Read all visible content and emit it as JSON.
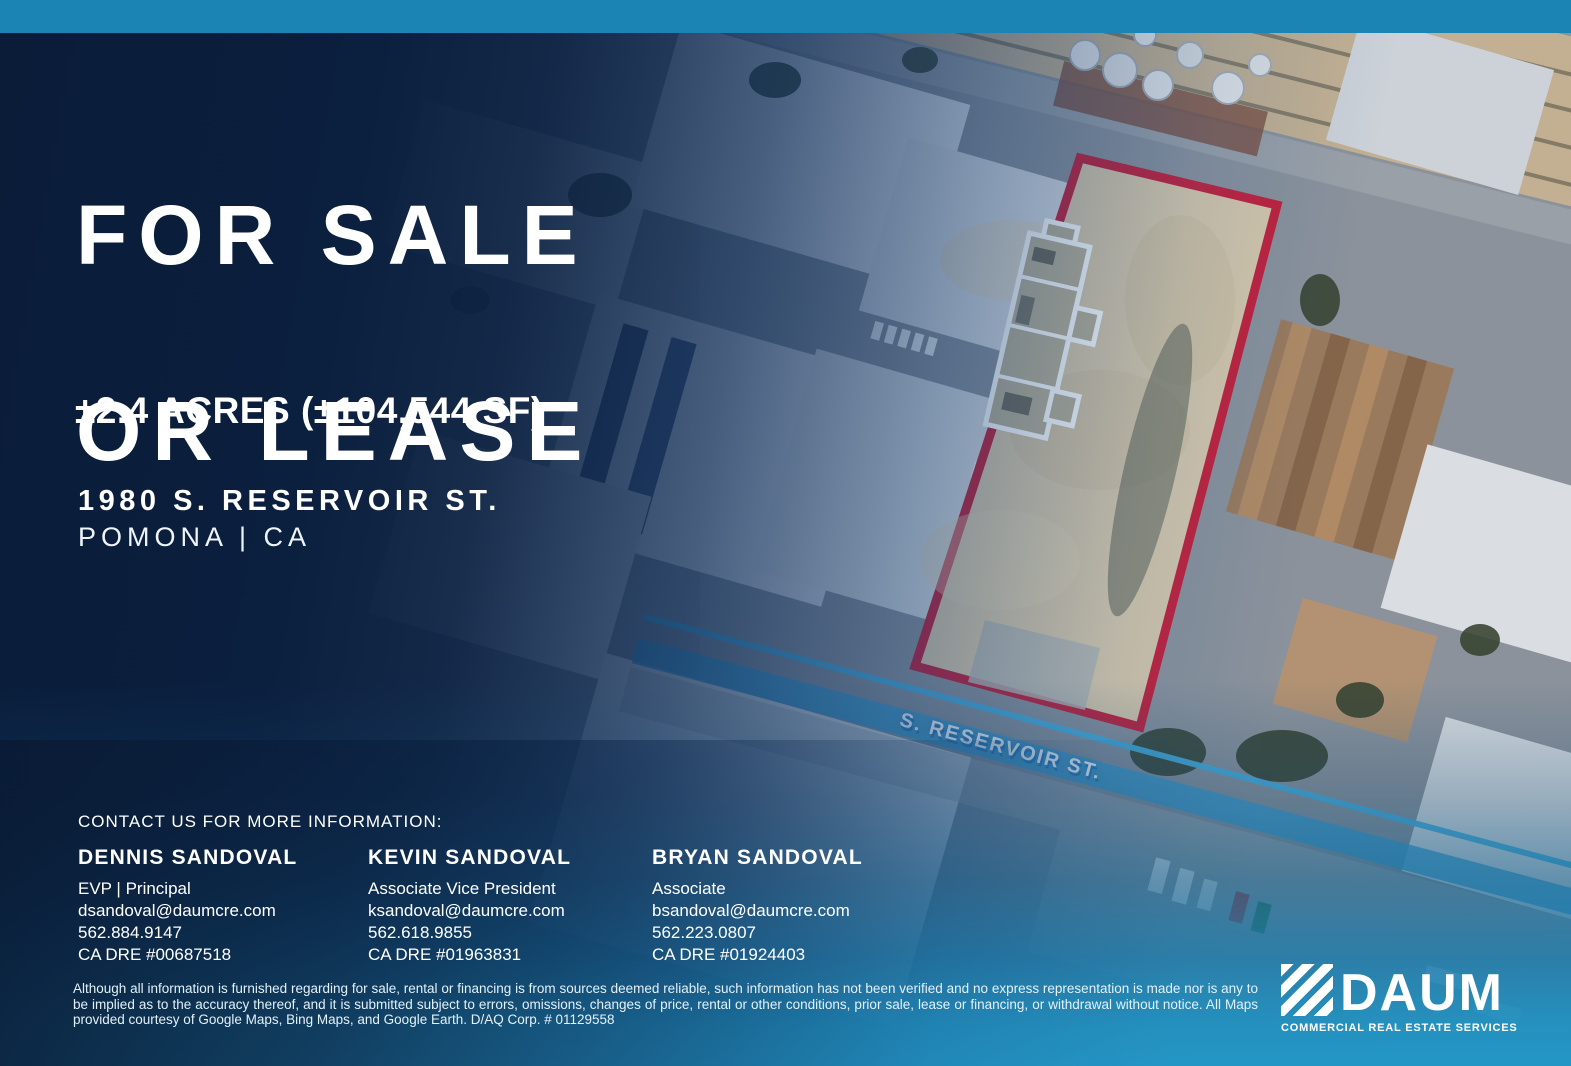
{
  "listing": {
    "title_line1": "FOR SALE",
    "title_line2": "OR LEASE",
    "size": "±2.4 ACRES (±104,544 SF)",
    "address_line1": "1980 S. RESERVOIR ST.",
    "address_line2": "POMONA | CA"
  },
  "map": {
    "street_label": "S. RESERVOIR ST."
  },
  "contact": {
    "heading": "CONTACT US FOR MORE INFORMATION:",
    "agents": [
      {
        "name": "DENNIS SANDOVAL",
        "title": "EVP | Principal",
        "email": "dsandoval@daumcre.com",
        "phone": "562.884.9147",
        "license": "CA DRE #00687518"
      },
      {
        "name": "KEVIN SANDOVAL",
        "title": "Associate Vice President",
        "email": "ksandoval@daumcre.com",
        "phone": "562.618.9855",
        "license": "CA DRE #01963831"
      },
      {
        "name": "BRYAN SANDOVAL",
        "title": "Associate",
        "email": "bsandoval@daumcre.com",
        "phone": "562.223.0807",
        "license": "CA DRE #01924403"
      }
    ]
  },
  "footer": {
    "disclaimer": "Although all information is furnished regarding for sale, rental or financing is from sources deemed reliable, such information has not been verified and no express representation is made nor is any to be implied as to the accuracy thereof, and it is submitted subject to errors, omissions, changes of price, rental or other conditions, prior sale, lease or financing, or withdrawal without notice. All Maps provided courtesy of Google Maps, Bing Maps, and Google Earth. D/AQ Corp. # 01129558",
    "logo_name": "DAUM",
    "logo_tagline": "COMMERCIAL REAL ESTATE SERVICES"
  },
  "colors": {
    "accent_red": "#c3203a",
    "navy": "#0a1c38",
    "teal_bottom": "#2496c6",
    "topbar_blue": "#1b84b5",
    "parcel_dirt": "#d8c8aa"
  }
}
